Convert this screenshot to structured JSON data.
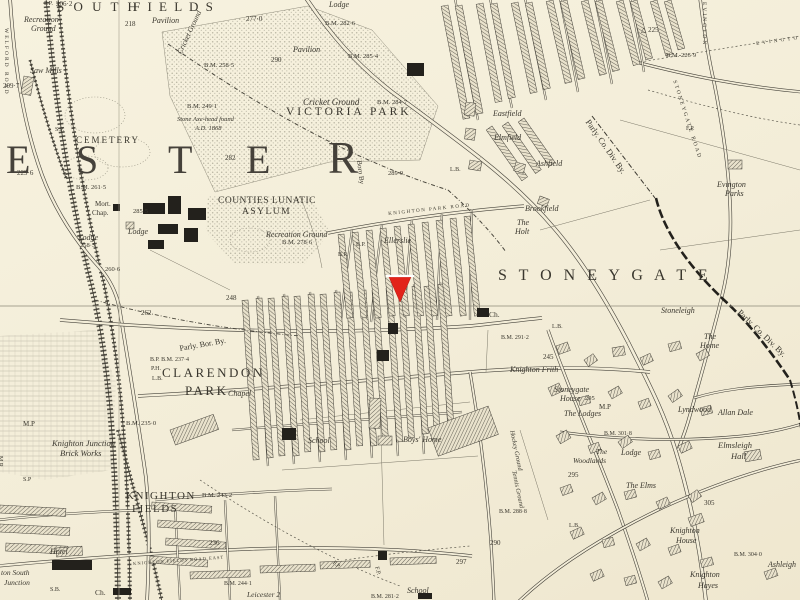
{
  "marker": {
    "color": "#e2231a",
    "points": "389,277 411,277 400,302",
    "top_edge": {
      "x1": 386,
      "y1": 276,
      "x2": 414,
      "y2": 276,
      "color": "#ffffff"
    }
  },
  "colors": {
    "paper": "#f3edd8",
    "ink": "#3a372e",
    "stipple": "#c3bfae",
    "marker_red": "#e2231a"
  },
  "labels": [
    {
      "n": "district-south",
      "t": "S O U T H",
      "x": 57,
      "y": 0,
      "fs": 13,
      "sp": 3
    },
    {
      "n": "district-fields",
      "t": "F I E L D S",
      "x": 133,
      "y": 0,
      "fs": 13,
      "sp": 2
    },
    {
      "n": "pavilion-north",
      "t": "Pavilion",
      "x": 152,
      "y": 17,
      "fs": 8,
      "it": 1
    },
    {
      "n": "cricket-ground-north",
      "t": "Cricket Ground",
      "x": 176,
      "y": 52,
      "fs": 7.5,
      "it": 1,
      "rot": -65
    },
    {
      "n": "spot-height",
      "t": "218",
      "x": 125,
      "y": 21,
      "fs": 7
    },
    {
      "n": "spot-height",
      "t": "277·0",
      "x": 246,
      "y": 16,
      "fs": 7
    },
    {
      "n": "footpath-abbr",
      "t": "P.P.",
      "x": 44,
      "y": 1,
      "fs": 6.5
    },
    {
      "n": "spot-height",
      "t": "206·2",
      "x": 56,
      "y": 1,
      "fs": 7
    },
    {
      "n": "recreation-ground-nw",
      "t": "Recreation",
      "x": 24,
      "y": 16,
      "fs": 8,
      "it": 1
    },
    {
      "n": "recreation-ground-nw",
      "t": "Ground",
      "x": 31,
      "y": 25,
      "fs": 8,
      "it": 1
    },
    {
      "n": "saw-mills",
      "t": "Saw Mills",
      "x": 30,
      "y": 67,
      "fs": 8,
      "it": 1
    },
    {
      "n": "spot-height",
      "t": "209·7",
      "x": 3,
      "y": 83,
      "fs": 7
    },
    {
      "n": "welford-road",
      "t": "WELFORD ROAD",
      "x": 8,
      "y": 28,
      "fs": 5.5,
      "sp": 2,
      "rot": 90
    },
    {
      "n": "cemetery",
      "t": "CEMETERY",
      "x": 76,
      "y": 136,
      "fs": 9,
      "sp": 2
    },
    {
      "n": "signal-post",
      "t": "S.P.",
      "x": 55,
      "y": 127,
      "fs": 6
    },
    {
      "n": "cemetery-lodge",
      "t": "Lodge",
      "x": 78,
      "y": 234,
      "fs": 8,
      "it": 1
    },
    {
      "n": "spot-height",
      "t": "258·5",
      "x": 80,
      "y": 243,
      "fs": 6.5
    },
    {
      "n": "mortuary-chapel",
      "t": "Mort.",
      "x": 95,
      "y": 201,
      "fs": 7
    },
    {
      "n": "mortuary-chapel",
      "t": "Chap.",
      "x": 92,
      "y": 210,
      "fs": 7
    },
    {
      "n": "asylum-lodge",
      "t": "Lodge",
      "x": 128,
      "y": 228,
      "fs": 8,
      "it": 1
    },
    {
      "n": "spot-height",
      "t": "285·5",
      "x": 133,
      "y": 209,
      "fs": 6.5
    },
    {
      "n": "benchmark",
      "t": "B.M. 261·5",
      "x": 76,
      "y": 185,
      "fs": 6.5
    },
    {
      "n": "spot-height",
      "t": "229·6",
      "x": 17,
      "y": 170,
      "fs": 7
    },
    {
      "n": "leicester-letter",
      "t": "E",
      "x": 6,
      "y": 140,
      "fs": 40,
      "big": 1
    },
    {
      "n": "leicester-letter",
      "t": "S",
      "x": 76,
      "y": 140,
      "fs": 40,
      "big": 1
    },
    {
      "n": "leicester-letter",
      "t": "T",
      "x": 168,
      "y": 140,
      "fs": 40,
      "big": 1
    },
    {
      "n": "leicester-letter",
      "t": "E",
      "x": 246,
      "y": 140,
      "fs": 40,
      "big": 1
    },
    {
      "n": "leicester-letter",
      "t": "R",
      "x": 328,
      "y": 136,
      "fs": 45,
      "big": 1
    },
    {
      "n": "benchmark",
      "t": "B.M. 258·5",
      "x": 204,
      "y": 63,
      "fs": 6.5
    },
    {
      "n": "benchmark",
      "t": "B.M. 249·1",
      "x": 187,
      "y": 104,
      "fs": 6.5
    },
    {
      "n": "antiquity-note",
      "t": "Stone Axe-head found",
      "x": 177,
      "y": 117,
      "fs": 6.5,
      "it": 1
    },
    {
      "n": "antiquity-note",
      "t": "A.D. 1868",
      "x": 195,
      "y": 126,
      "fs": 6.5,
      "it": 1
    },
    {
      "n": "spot-height",
      "t": "282",
      "x": 225,
      "y": 155,
      "fs": 7
    },
    {
      "n": "park-lodge",
      "t": "Lodge",
      "x": 329,
      "y": 1,
      "fs": 8,
      "it": 1
    },
    {
      "n": "benchmark",
      "t": "B.M. 282·6",
      "x": 325,
      "y": 21,
      "fs": 6.5
    },
    {
      "n": "spot-height",
      "t": "290",
      "x": 271,
      "y": 57,
      "fs": 7
    },
    {
      "n": "pavilion-park",
      "t": "Pavilion",
      "x": 293,
      "y": 46,
      "fs": 8,
      "it": 1
    },
    {
      "n": "benchmark",
      "t": "B.M. 285·4",
      "x": 348,
      "y": 54,
      "fs": 6.5
    },
    {
      "n": "cricket-ground",
      "t": "Cricket Ground",
      "x": 303,
      "y": 98,
      "fs": 9,
      "it": 1
    },
    {
      "n": "victoria-park",
      "t": "VICTORIA PARK",
      "x": 286,
      "y": 107,
      "fs": 11.5,
      "sp": 3
    },
    {
      "n": "benchmark",
      "t": "B.M. 284·7",
      "x": 377,
      "y": 100,
      "fs": 6.5
    },
    {
      "n": "spot-height",
      "t": "289·9",
      "x": 388,
      "y": 171,
      "fs": 6.5
    },
    {
      "n": "borough-boundary-label",
      "t": "Boro By",
      "x": 362,
      "y": 160,
      "fs": 7,
      "rot": 83
    },
    {
      "n": "asylum-name",
      "t": "COUNTIES LUNATIC",
      "x": 218,
      "y": 197,
      "fs": 9.5,
      "sp": 0.5
    },
    {
      "n": "asylum-name",
      "t": "ASYLUM",
      "x": 242,
      "y": 208,
      "fs": 9.5,
      "sp": 1.5
    },
    {
      "n": "recreation-ground-asylum",
      "t": "Recreation Ground",
      "x": 266,
      "y": 231,
      "fs": 8,
      "it": 1
    },
    {
      "n": "benchmark",
      "t": "B.M. 278·6",
      "x": 282,
      "y": 240,
      "fs": 6.5
    },
    {
      "n": "spot-height",
      "t": "260·6",
      "x": 105,
      "y": 267,
      "fs": 6.5
    },
    {
      "n": "spot-height",
      "t": "248",
      "x": 226,
      "y": 295,
      "fs": 7
    },
    {
      "n": "spot-height",
      "t": "262",
      "x": 141,
      "y": 310,
      "fs": 7
    },
    {
      "n": "boundary-post",
      "t": "B.P.",
      "x": 356,
      "y": 242,
      "fs": 6
    },
    {
      "n": "boundary-post",
      "t": "B.P.",
      "x": 338,
      "y": 252,
      "fs": 6
    },
    {
      "n": "knighton-park-road",
      "t": "KNIGHTON PARK ROAD",
      "x": 388,
      "y": 212,
      "fs": 5,
      "sp": 1.5,
      "rot": -6
    },
    {
      "n": "house-ellerslie",
      "t": "Ellerslie",
      "x": 384,
      "y": 237,
      "fs": 8,
      "it": 1
    },
    {
      "n": "house-eastfield",
      "t": "Eastfield",
      "x": 493,
      "y": 110,
      "fs": 8,
      "it": 1
    },
    {
      "n": "house-elmfield",
      "t": "Elmfield",
      "x": 494,
      "y": 134,
      "fs": 8,
      "it": 1
    },
    {
      "n": "house-ashfield",
      "t": "Ashfield",
      "x": 536,
      "y": 160,
      "fs": 8,
      "it": 1
    },
    {
      "n": "house-brookfield",
      "t": "Brookfield",
      "x": 525,
      "y": 205,
      "fs": 8,
      "it": 1
    },
    {
      "n": "house-the-holt",
      "t": "The",
      "x": 517,
      "y": 219,
      "fs": 8,
      "it": 1
    },
    {
      "n": "house-the-holt",
      "t": "Holt",
      "x": 515,
      "y": 228,
      "fs": 8,
      "it": 1
    },
    {
      "n": "letter-box",
      "t": "L.B.",
      "x": 450,
      "y": 167,
      "fs": 6
    },
    {
      "n": "trig-point",
      "t": "△ 225",
      "x": 641,
      "y": 27,
      "fs": 7
    },
    {
      "n": "benchmark",
      "t": "B.M. 226·9",
      "x": 666,
      "y": 53,
      "fs": 6.5
    },
    {
      "n": "evington-road",
      "t": "EVINGTON",
      "x": 706,
      "y": 2,
      "fs": 5.5,
      "sp": 2,
      "rot": 90
    },
    {
      "n": "evington-footpath",
      "t": "E V I N G T O N",
      "x": 756,
      "y": 42,
      "fs": 5,
      "sp": 1,
      "rot": -8
    },
    {
      "n": "parly-county-div-boundary",
      "t": "Parly. Co. Div. By.",
      "x": 591,
      "y": 118,
      "fs": 8.5,
      "rot": 55
    },
    {
      "n": "evington-parks",
      "t": "Evington",
      "x": 717,
      "y": 181,
      "fs": 8,
      "it": 1
    },
    {
      "n": "evington-parks",
      "t": "Parks",
      "x": 725,
      "y": 190,
      "fs": 8,
      "it": 1
    },
    {
      "n": "footpath",
      "t": "F.P.",
      "x": 686,
      "y": 126,
      "fs": 6
    },
    {
      "n": "stoneygate-road",
      "t": "STONEYGATE ROAD",
      "x": 676,
      "y": 80,
      "fs": 5.5,
      "sp": 2,
      "rot": 72
    },
    {
      "n": "district-stoneygate",
      "t": "S T O N E Y G A T E",
      "x": 498,
      "y": 268,
      "fs": 16,
      "sp": 4
    },
    {
      "n": "house-stoneleigh",
      "t": "Stoneleigh",
      "x": 661,
      "y": 307,
      "fs": 8,
      "it": 1
    },
    {
      "n": "house-the-home",
      "t": "The",
      "x": 704,
      "y": 333,
      "fs": 8,
      "it": 1
    },
    {
      "n": "house-the-home",
      "t": "Home",
      "x": 700,
      "y": 342,
      "fs": 8,
      "it": 1
    },
    {
      "n": "parly-county-div-boundary",
      "t": "Parly. Co. Div. By.",
      "x": 742,
      "y": 308,
      "fs": 8.5,
      "rot": 44
    },
    {
      "n": "church-abbr",
      "t": "Ch.",
      "x": 489,
      "y": 311,
      "fs": 7.5
    },
    {
      "n": "benchmark",
      "t": "B.M. 291·2",
      "x": 501,
      "y": 335,
      "fs": 6
    },
    {
      "n": "letter-box",
      "t": "L.B.",
      "x": 552,
      "y": 324,
      "fs": 6
    },
    {
      "n": "house-knighton-frith",
      "t": "Knighton Frith",
      "x": 510,
      "y": 366,
      "fs": 8,
      "it": 1
    },
    {
      "n": "spot-height",
      "t": "245",
      "x": 543,
      "y": 354,
      "fs": 7
    },
    {
      "n": "house-stoneygate-house",
      "t": "Stoneygate",
      "x": 554,
      "y": 386,
      "fs": 8,
      "it": 1
    },
    {
      "n": "house-stoneygate-house",
      "t": "House",
      "x": 560,
      "y": 395,
      "fs": 8,
      "it": 1
    },
    {
      "n": "spot-height",
      "t": "295",
      "x": 585,
      "y": 396,
      "fs": 6.5
    },
    {
      "n": "parly-borough-boundary",
      "t": "Parly. Bor. By.",
      "x": 179,
      "y": 345,
      "fs": 8,
      "rot": -10
    },
    {
      "n": "benchmark",
      "t": "B.P. B.M. 237·4",
      "x": 150,
      "y": 357,
      "fs": 6
    },
    {
      "n": "public-house",
      "t": "P.H.",
      "x": 151,
      "y": 366,
      "fs": 6
    },
    {
      "n": "letter-box",
      "t": "L.B.",
      "x": 152,
      "y": 376,
      "fs": 6
    },
    {
      "n": "district-clarendon",
      "t": "CLARENDON",
      "x": 162,
      "y": 366,
      "fs": 13,
      "sp": 2.5
    },
    {
      "n": "district-clarendon",
      "t": "PARK",
      "x": 185,
      "y": 384,
      "fs": 13,
      "sp": 2.5
    },
    {
      "n": "chapel",
      "t": "Chapel",
      "x": 228,
      "y": 390,
      "fs": 8,
      "it": 1
    },
    {
      "n": "school-clarendon",
      "t": "School",
      "x": 308,
      "y": 437,
      "fs": 8,
      "it": 1
    },
    {
      "n": "boys-home",
      "t": "Boys' Home",
      "x": 403,
      "y": 436,
      "fs": 8,
      "it": 1
    },
    {
      "n": "hockey-ground",
      "t": "Hockey Ground",
      "x": 514,
      "y": 430,
      "fs": 6.5,
      "it": 1,
      "rot": 78
    },
    {
      "n": "tennis-ground",
      "t": "Tennis Ground",
      "x": 516,
      "y": 470,
      "fs": 6.5,
      "it": 1,
      "rot": 78
    },
    {
      "n": "benchmark",
      "t": "B.M. 288·8",
      "x": 499,
      "y": 509,
      "fs": 6
    },
    {
      "n": "spot-height",
      "t": "290",
      "x": 490,
      "y": 540,
      "fs": 7
    },
    {
      "n": "spot-height",
      "t": "297",
      "x": 456,
      "y": 559,
      "fs": 7
    },
    {
      "n": "footpath",
      "t": "F.P.",
      "x": 335,
      "y": 560,
      "fs": 6,
      "rot": 40
    },
    {
      "n": "footpath",
      "t": "F.P.",
      "x": 379,
      "y": 566,
      "fs": 6,
      "rot": 75
    },
    {
      "n": "school-south",
      "t": "School",
      "x": 407,
      "y": 587,
      "fs": 8,
      "it": 1
    },
    {
      "n": "benchmark",
      "t": "B.M. 281·2",
      "x": 371,
      "y": 594,
      "fs": 6
    },
    {
      "n": "district-knighton-fields",
      "t": "KNIGHTON",
      "x": 126,
      "y": 491,
      "fs": 11,
      "sp": 1.5
    },
    {
      "n": "district-knighton-fields",
      "t": "FIELDS",
      "x": 132,
      "y": 504,
      "fs": 11,
      "sp": 1.5
    },
    {
      "n": "brick-works",
      "t": "Knighton Junction",
      "x": 52,
      "y": 439,
      "fs": 8.5,
      "it": 1
    },
    {
      "n": "brick-works",
      "t": "Brick Works",
      "x": 60,
      "y": 449,
      "fs": 8.5,
      "it": 1
    },
    {
      "n": "benchmark",
      "t": "B.M. 235·0",
      "x": 126,
      "y": 421,
      "fs": 6.5
    },
    {
      "n": "benchmark",
      "t": "B.M. 243·2",
      "x": 202,
      "y": 493,
      "fs": 6.5
    },
    {
      "n": "spot-height",
      "t": "236",
      "x": 209,
      "y": 540,
      "fs": 7
    },
    {
      "n": "mile-post",
      "t": "M.P",
      "x": 23,
      "y": 421,
      "fs": 7
    },
    {
      "n": "signal-post",
      "t": "S.P",
      "x": 23,
      "y": 477,
      "fs": 6
    },
    {
      "n": "midland-railway",
      "t": "M.R.",
      "x": 3,
      "y": 456,
      "fs": 6,
      "rot": 90
    },
    {
      "n": "hotel",
      "t": "Hotel",
      "x": 50,
      "y": 548,
      "fs": 8,
      "it": 1
    },
    {
      "n": "knighton-south-junction",
      "t": "ton South",
      "x": 1,
      "y": 569,
      "fs": 7.5,
      "it": 1
    },
    {
      "n": "knighton-south-junction",
      "t": "Junction",
      "x": 4,
      "y": 579,
      "fs": 7.5,
      "it": 1
    },
    {
      "n": "signal-box",
      "t": "S.B.",
      "x": 50,
      "y": 587,
      "fs": 6
    },
    {
      "n": "chapel-abbr",
      "t": "Ch.",
      "x": 95,
      "y": 589,
      "fs": 7.5
    },
    {
      "n": "knighton-fields-road-east",
      "t": "KNIGHTON FIELDS ROAD EAST",
      "x": 133,
      "y": 562,
      "fs": 4.5,
      "sp": 1,
      "rot": -4
    },
    {
      "n": "benchmark",
      "t": "B.M. 244·1",
      "x": 224,
      "y": 581,
      "fs": 6
    },
    {
      "n": "milestone",
      "t": "Leicester 2",
      "x": 247,
      "y": 591,
      "fs": 7.5,
      "it": 1
    },
    {
      "n": "mile-post",
      "t": "M.P",
      "x": 599,
      "y": 404,
      "fs": 7
    },
    {
      "n": "house-the-lodges",
      "t": "The Lodges",
      "x": 564,
      "y": 410,
      "fs": 8,
      "it": 1
    },
    {
      "n": "benchmark",
      "t": "B.M. 301·8",
      "x": 604,
      "y": 431,
      "fs": 6
    },
    {
      "n": "house-lyndwood",
      "t": "Lyndwood",
      "x": 678,
      "y": 406,
      "fs": 8,
      "it": 1
    },
    {
      "n": "house-allan-dale",
      "t": "Allan Dale",
      "x": 718,
      "y": 409,
      "fs": 8,
      "it": 1
    },
    {
      "n": "house-elmsleigh-hall",
      "t": "Elmsleigh",
      "x": 718,
      "y": 441,
      "fs": 8.5,
      "it": 1
    },
    {
      "n": "house-elmsleigh-hall",
      "t": "Hall",
      "x": 731,
      "y": 452,
      "fs": 8.5,
      "it": 1
    },
    {
      "n": "house-the-woodlands",
      "t": "The",
      "x": 596,
      "y": 448,
      "fs": 7.5,
      "it": 1
    },
    {
      "n": "house-the-woodlands",
      "t": "Woodlands",
      "x": 573,
      "y": 457,
      "fs": 7.5,
      "it": 1
    },
    {
      "n": "house-lodge",
      "t": "Lodge",
      "x": 621,
      "y": 449,
      "fs": 8,
      "it": 1
    },
    {
      "n": "house-the-elms",
      "t": "The Elms",
      "x": 626,
      "y": 482,
      "fs": 8,
      "it": 1
    },
    {
      "n": "spot-height",
      "t": "295",
      "x": 568,
      "y": 472,
      "fs": 7
    },
    {
      "n": "spot-height",
      "t": "305",
      "x": 704,
      "y": 500,
      "fs": 7
    },
    {
      "n": "letter-box",
      "t": "L.B.",
      "x": 569,
      "y": 523,
      "fs": 6
    },
    {
      "n": "house-knighton-house",
      "t": "Knighton",
      "x": 670,
      "y": 527,
      "fs": 8,
      "it": 1
    },
    {
      "n": "house-knighton-house",
      "t": "House",
      "x": 676,
      "y": 537,
      "fs": 8,
      "it": 1
    },
    {
      "n": "benchmark",
      "t": "B.M. 304·0",
      "x": 734,
      "y": 552,
      "fs": 6
    },
    {
      "n": "house-ashleigh",
      "t": "Ashleigh",
      "x": 768,
      "y": 561,
      "fs": 8,
      "it": 1
    },
    {
      "n": "house-knighton-hayes",
      "t": "Knighton",
      "x": 690,
      "y": 571,
      "fs": 8,
      "it": 1
    },
    {
      "n": "house-knighton-hayes",
      "t": "Hayes",
      "x": 698,
      "y": 582,
      "fs": 8,
      "it": 1
    }
  ]
}
